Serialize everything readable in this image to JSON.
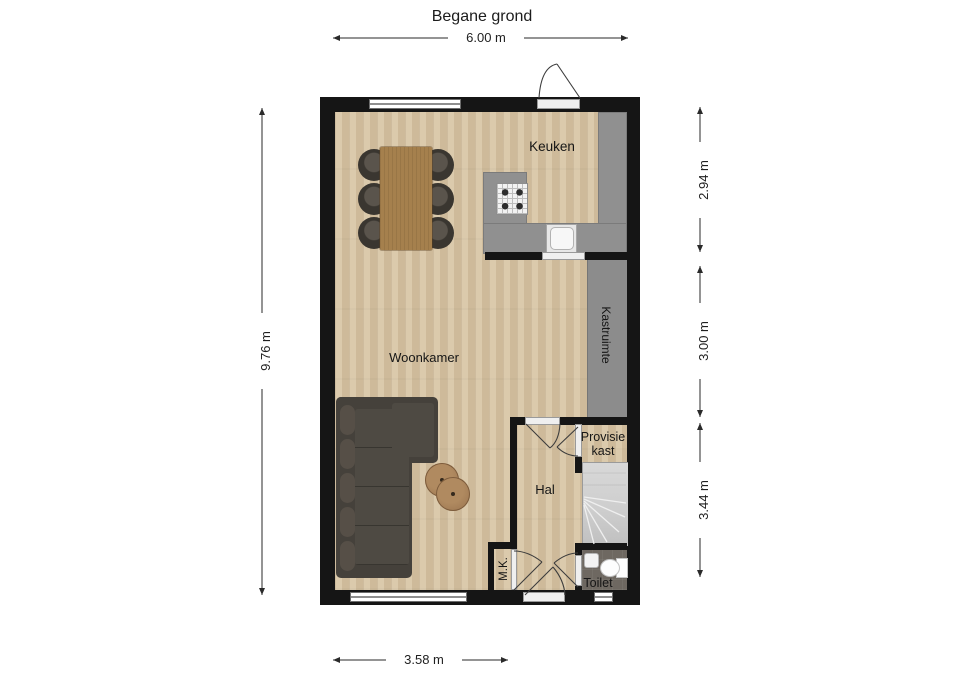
{
  "title": "Begane grond",
  "dims": {
    "top": "6.00 m",
    "left": "9.76 m",
    "right_top": "2.94 m",
    "right_mid": "3.00 m",
    "right_bottom": "3.44 m",
    "bottom": "3.58 m"
  },
  "rooms": {
    "keuken": "Keuken",
    "woonkamer": "Woonkamer",
    "kastruimte": "Kastruimte",
    "provisiekast": "Provisie kast",
    "hal": "Hal",
    "mk": "M.K.",
    "toilet": "Toilet"
  },
  "colors": {
    "wall": "#151515",
    "wood_floor": "#d7c4a3",
    "counter_gray": "#909090",
    "closet_gray": "#8c8c8c",
    "toilet_floor": "#6e6861",
    "stairs": "#cecece",
    "sofa": "#45413b",
    "table_wood": "#a5804d",
    "background": "#ffffff"
  }
}
